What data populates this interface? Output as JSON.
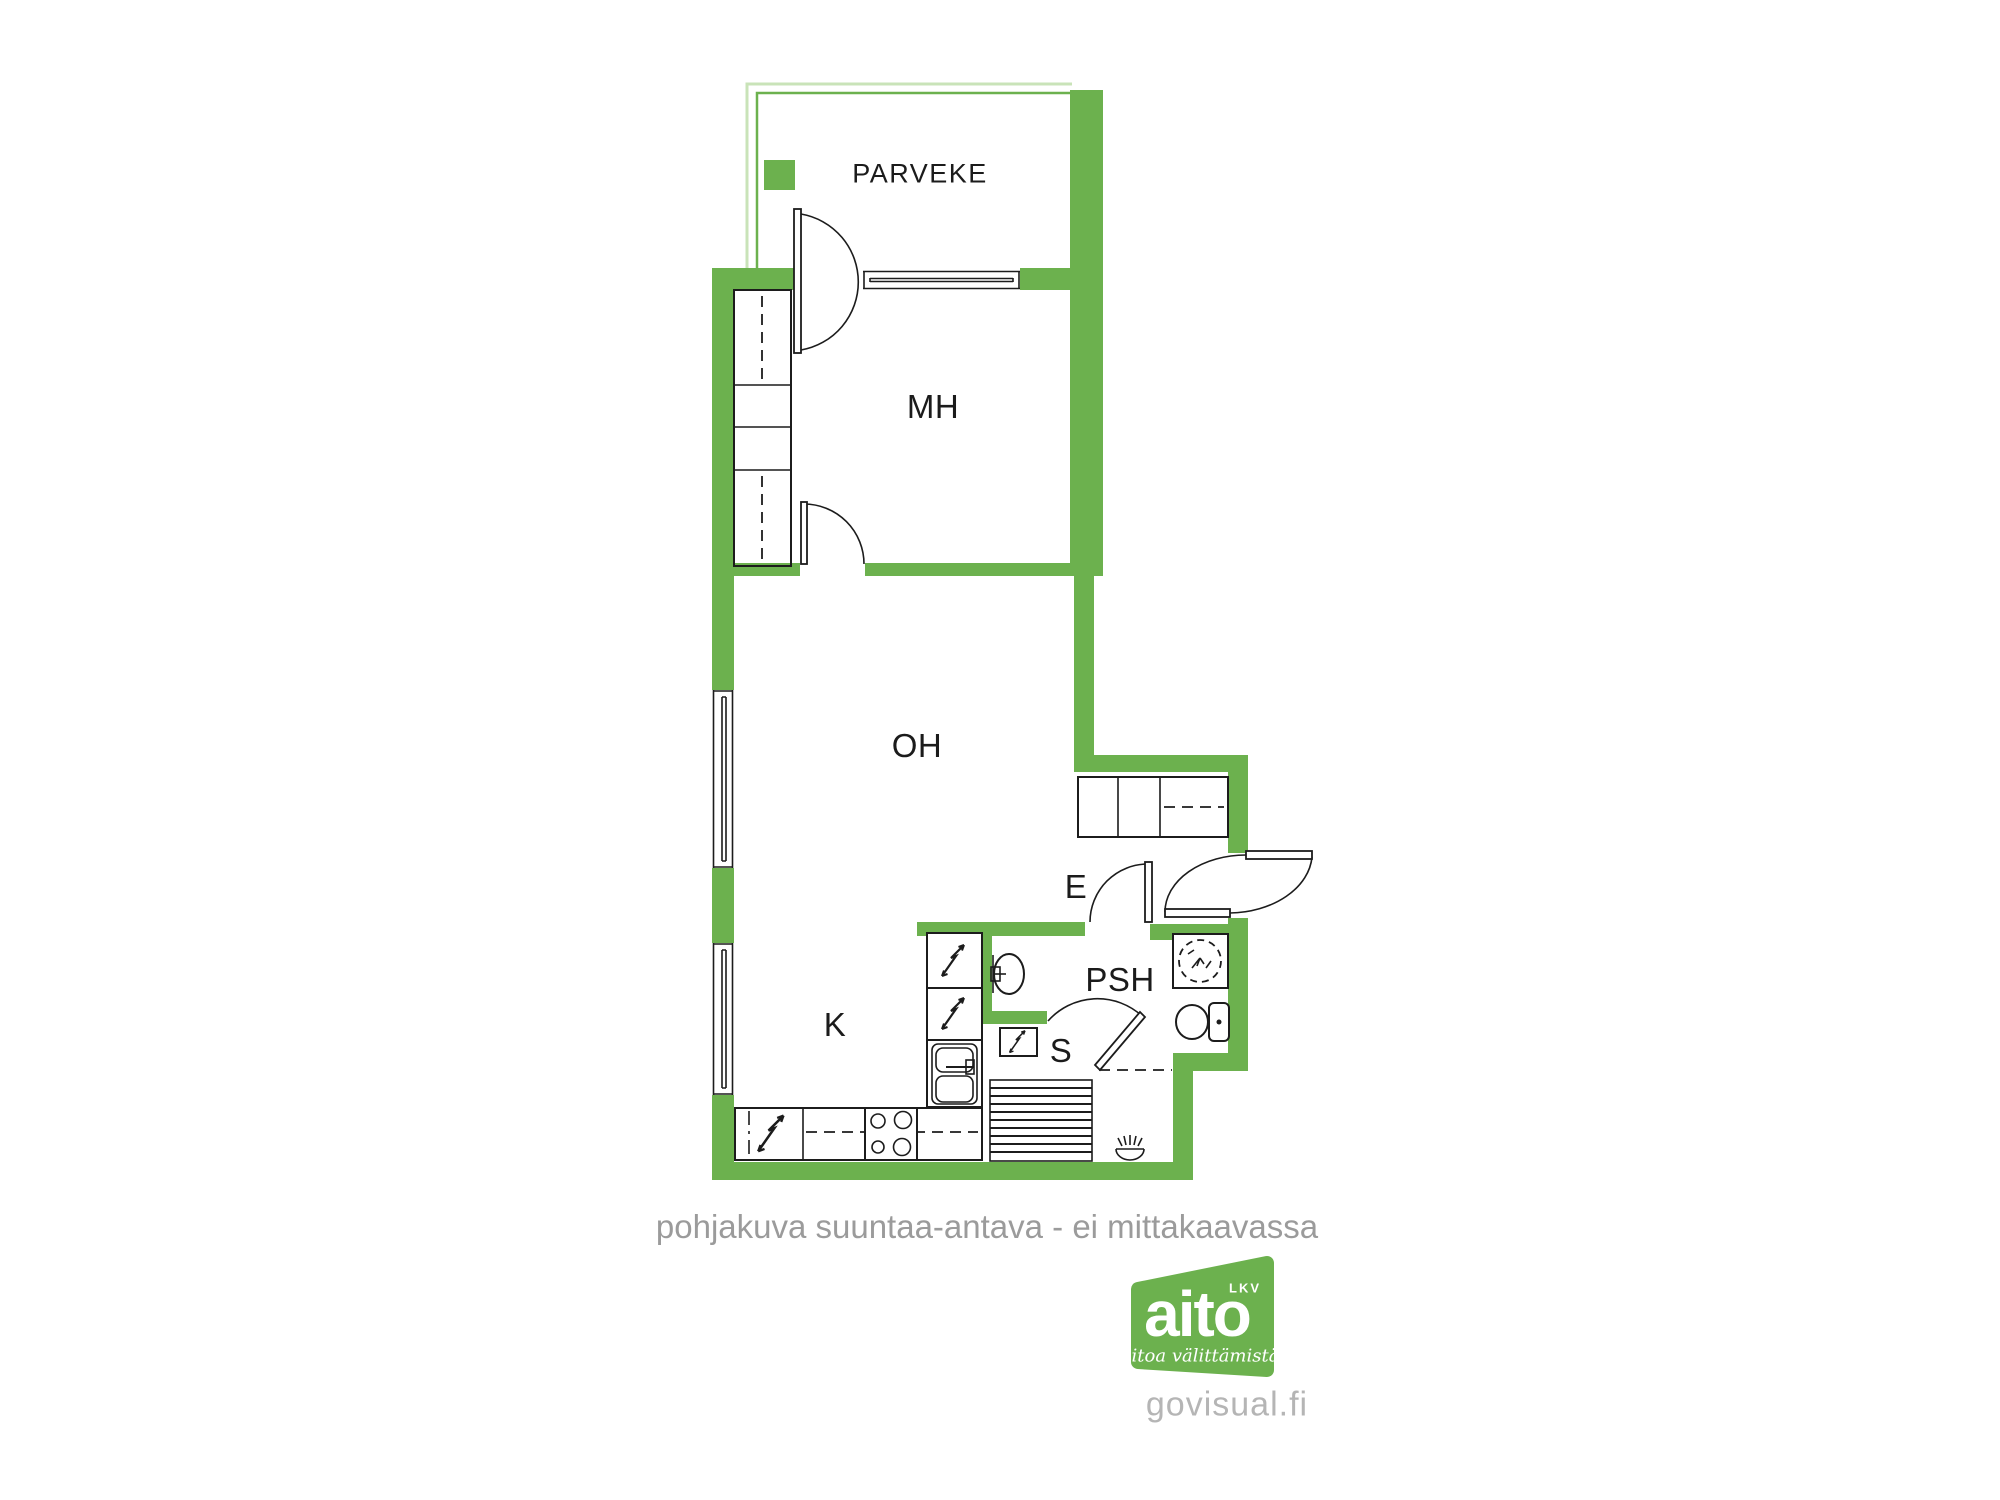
{
  "plan": {
    "rooms": {
      "parveke": {
        "label": "PARVEKE"
      },
      "mh": {
        "label": "MH"
      },
      "oh": {
        "label": "OH"
      },
      "k": {
        "label": "K"
      },
      "e": {
        "label": "E"
      },
      "psh": {
        "label": "PSH"
      },
      "s": {
        "label": "S"
      }
    },
    "caption": "pohjakuva suuntaa-antava - ei mittakaavassa"
  },
  "branding": {
    "logo_text": "aito",
    "logo_badge": "LKV",
    "logo_tagline": "Aitoa välittämistä",
    "website": "govisual.fi"
  },
  "colors": {
    "wall_green": "#6cb14e",
    "railing_light_green": "#c9e3b8",
    "line_black": "#1c1c1c",
    "caption_gray": "#9b9b9b",
    "website_gray": "#b5b5b5",
    "background": "#ffffff"
  }
}
